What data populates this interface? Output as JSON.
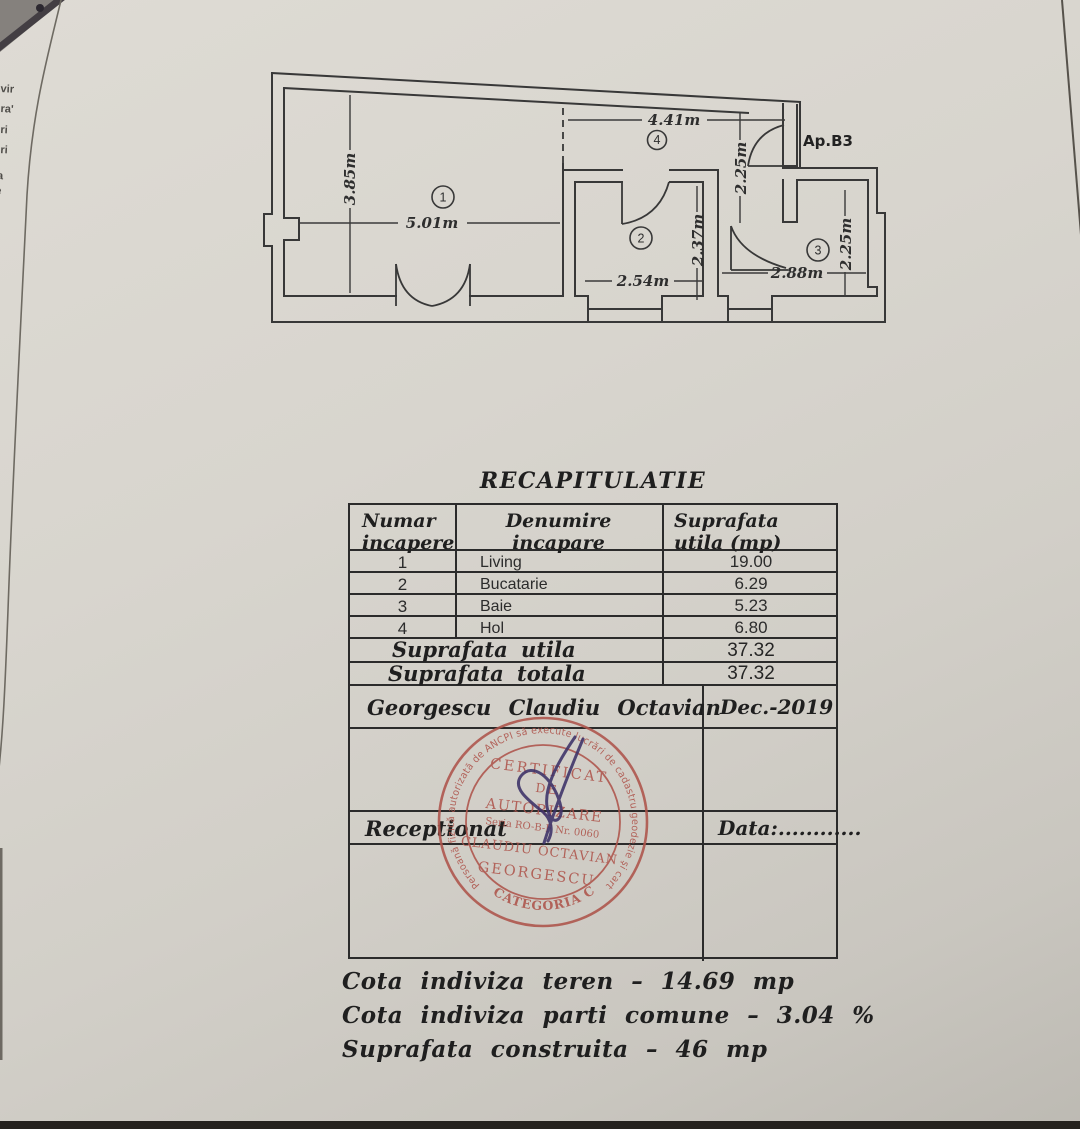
{
  "floor_plan": {
    "apartment_label": "Ap.B3",
    "room_numbers": [
      "1",
      "2",
      "3",
      "4"
    ],
    "dimensions": {
      "living_width": "5.01m",
      "living_height": "3.85m",
      "hol_width": "4.41m",
      "hol_height": "2.25m",
      "kitchen_width": "2.54m",
      "kitchen_height": "2.37m",
      "bath_width": "2.88m",
      "bath_height": "2.25m"
    }
  },
  "recap": {
    "title": "RECAPITULATIE",
    "col1_header": [
      "Numar",
      "incapere"
    ],
    "col2_header": [
      "Denumire",
      "incapare"
    ],
    "col3_header": [
      "Suprafata",
      "utila (mp)"
    ],
    "rows": [
      {
        "num": "1",
        "name": "Living",
        "area": "19.00"
      },
      {
        "num": "2",
        "name": "Bucatarie",
        "area": "6.29"
      },
      {
        "num": "3",
        "name": "Baie",
        "area": "5.23"
      },
      {
        "num": "4",
        "name": "Hol",
        "area": "6.80"
      }
    ],
    "totals": [
      {
        "label": "Suprafata utila",
        "value": "37.32"
      },
      {
        "label": "Suprafata totala",
        "value": "37.32"
      }
    ],
    "signer": "Georgescu Claudiu Octavian",
    "date": "Dec.-2019",
    "reception_label": "Receptionat",
    "data_label": "Data:............"
  },
  "stamp": {
    "ring_text": "Persoană fizică autorizată de ANCPI să execute lucrări de cadastru geodezie şi cartografie",
    "line1": "CERTIFICAT",
    "line2": "DE",
    "line3": "AUTORIZARE",
    "line4": "Seria RO-B-F Nr. 0060",
    "line5": "CLAUDIU OCTAVIAN",
    "line6": "GEORGESCU",
    "bottom_text": "CATEGORIA C",
    "color": "#ae544b"
  },
  "footer_lines": [
    "Cota indiviza teren – 14.69 mp",
    "Cota indiviza parti comune – 3.04 %",
    "Suprafata construita – 46 mp"
  ],
  "edge_fragments": [
    "vir",
    "ra'",
    "ri",
    "ri",
    "a",
    "e",
    "-"
  ]
}
